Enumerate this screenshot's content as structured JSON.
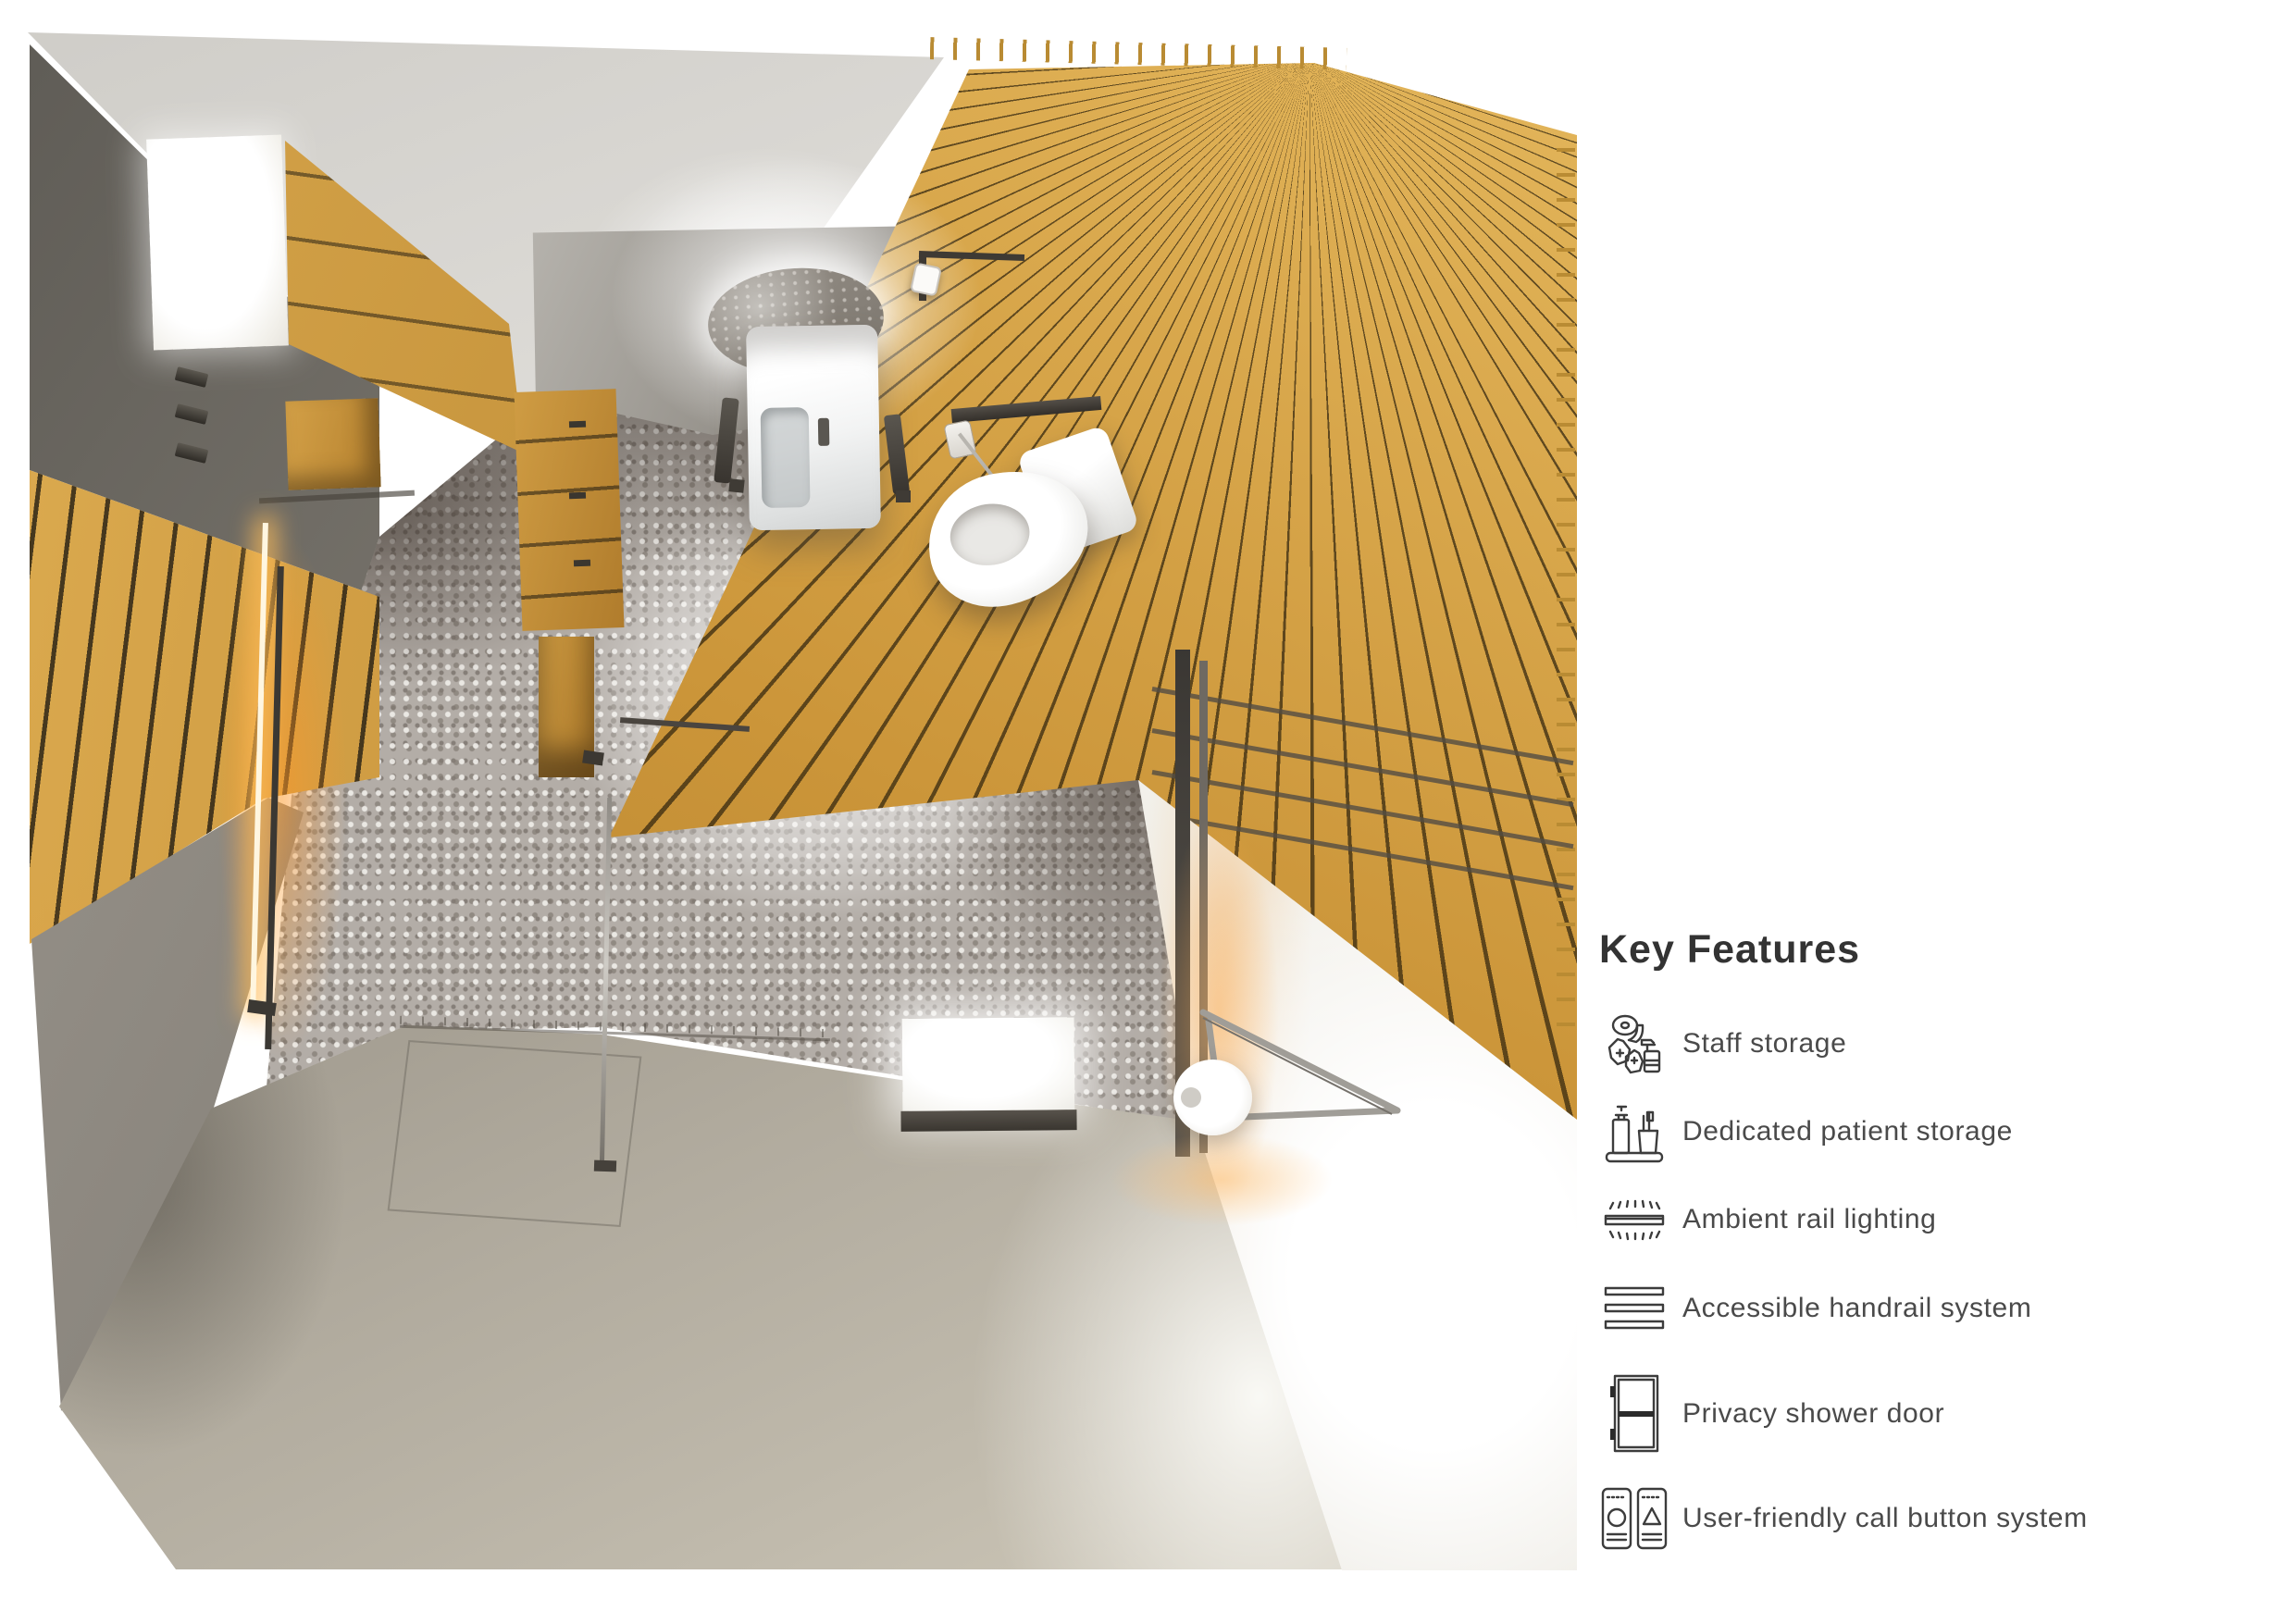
{
  "render": {
    "description": "Top-down 3D render of an accessible patient bathroom with wood slat walls, terrazzo shower floor, wall-hung sink with grab rails, wall-hung toilet, storage cabinets, LED-lit rails, glass shower screen and fold-down support rail",
    "materials": {
      "wood": "#c8943f",
      "wood_groove": "#4a3e22",
      "wall_grey": "#8c8881",
      "terrazzo": "#b3ada7",
      "floor": "#b2ac9f",
      "wall_white": "#f2f0ea",
      "accent_glow": "#f0a24e",
      "fixture_white": "#ffffff"
    }
  },
  "legend": {
    "title": "Key Features",
    "text_color": "#4a4a4a",
    "items": [
      {
        "label": "Staff storage",
        "icon": "staff-storage-icon"
      },
      {
        "label": "Dedicated patient storage",
        "icon": "patient-storage-icon"
      },
      {
        "label": "Ambient rail lighting",
        "icon": "ambient-rail-lighting-icon"
      },
      {
        "label": "Accessible handrail system",
        "icon": "accessible-handrail-icon"
      },
      {
        "label": "Privacy shower door",
        "icon": "privacy-shower-door-icon"
      },
      {
        "label": "User-friendly call button system",
        "icon": "call-button-icon"
      }
    ],
    "row_tops": [
      1082,
      1177,
      1272,
      1368,
      1482,
      1595
    ]
  }
}
